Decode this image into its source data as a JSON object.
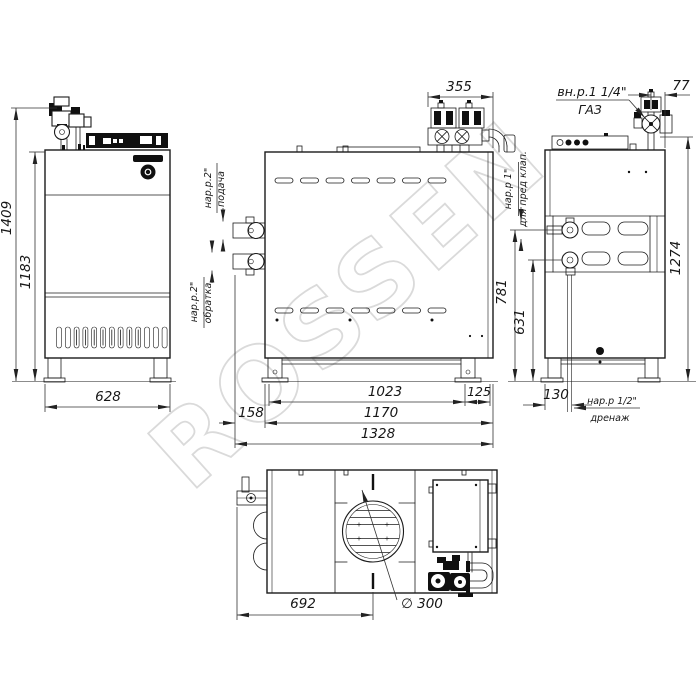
{
  "watermark": {
    "text": "ROSSEN"
  },
  "colors": {
    "line": "#1b1b1b",
    "dim": "#333333",
    "watermark": "#dadada",
    "background": "#ffffff"
  },
  "views": {
    "front": {
      "dims": {
        "total_height": "1409",
        "body_height": "1183",
        "width": "628"
      }
    },
    "side": {
      "dims": {
        "gas_train_width": "355",
        "legs_span": "1023",
        "leg_offset": "125",
        "pipe_protrusion": "158",
        "body_length": "1170",
        "overall_length": "1328"
      },
      "ports": {
        "supply": {
          "thread": "нар.р.2\"",
          "name": "подача"
        },
        "return": {
          "thread": "нар.р.2\"",
          "name": "обратка"
        }
      }
    },
    "right": {
      "dims": {
        "gas_offset": "77",
        "relief_height": "781",
        "return_height": "631",
        "total_height": "1274",
        "drain_offset": "130"
      },
      "labels": {
        "gas_thread": "вн.р.1 1/4\"",
        "gas_name": "ГАЗ",
        "relief_thread": "нар.р 1\"",
        "relief_name": "для пред клап.",
        "drain_thread": "нар.р 1/2\"",
        "drain_name": "дренаж"
      }
    },
    "top": {
      "dims": {
        "flue_offset": "692",
        "flue_diameter": "∅ 300"
      }
    }
  }
}
